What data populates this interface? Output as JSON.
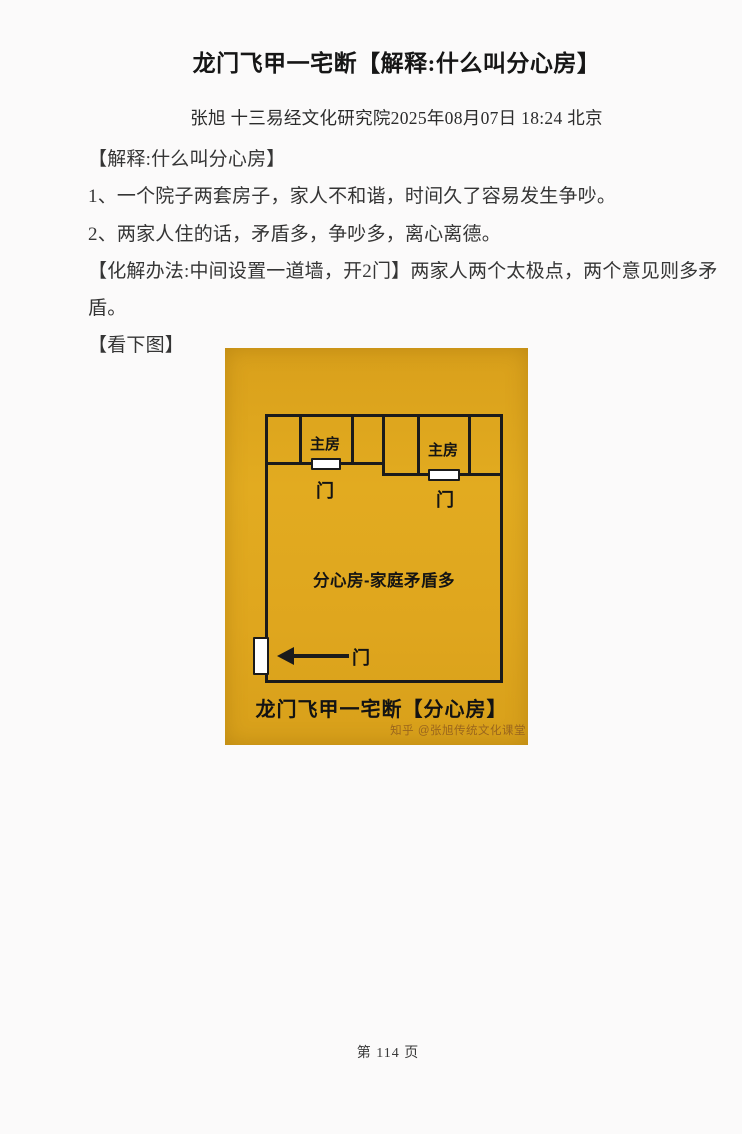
{
  "document": {
    "title": "龙门飞甲一宅断【解释:什么叫分心房】",
    "byline": "张旭 十三易经文化研究院2025年08月07日 18:24 北京",
    "body_lines": [
      "【解释:什么叫分心房】",
      "1、一个院子两套房子，家人不和谐，时间久了容易发生争吵。",
      "2、两家人住的话，矛盾多，争吵多，离心离德。",
      "【化解办法:中间设置一道墙，开2门】两家人两个太极点，两个意见则多矛盾。",
      "【看下图】"
    ],
    "footer": "第 114 页"
  },
  "diagram": {
    "room_left_label": "主房",
    "room_right_label": "主房",
    "door_left_label": "门",
    "door_right_label": "门",
    "door_main_label": "门",
    "center_label": "分心房-家庭矛盾多",
    "caption": "龙门飞甲一宅断【分心房】",
    "watermark": "知乎 @张旭传统文化课堂",
    "colors": {
      "card_background": "#dfa61e",
      "wall": "#1b1b1b",
      "door": "#ffffff",
      "watermark": "#9a661d"
    }
  }
}
